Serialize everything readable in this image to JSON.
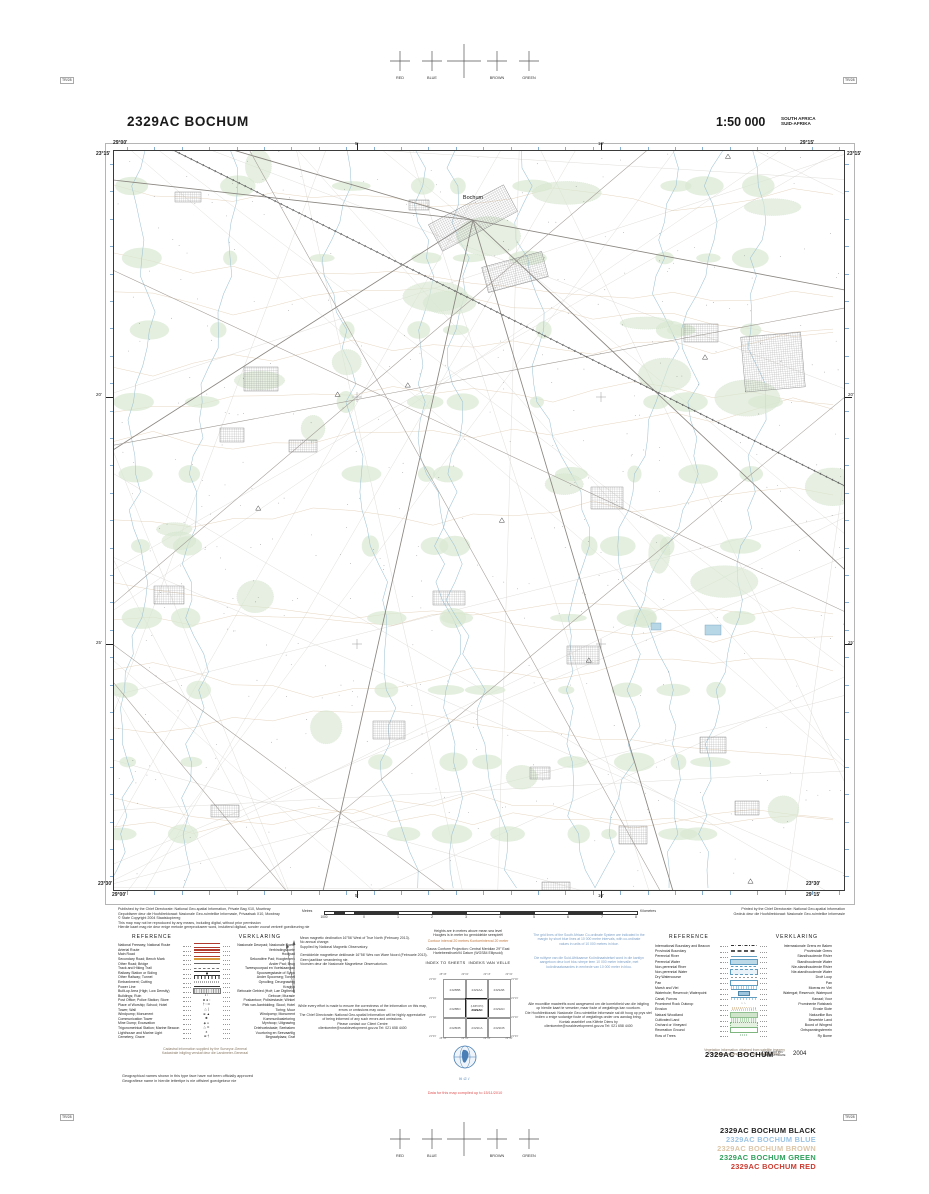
{
  "page": {
    "corner_mark": "TR/28"
  },
  "registration": {
    "labels": [
      "RED",
      "BLUE",
      "BROWN",
      "GREEN"
    ]
  },
  "header": {
    "sheet_title": "2329AC BOCHUM",
    "scale": "1:50 000",
    "country_line1": "SOUTH AFRICA",
    "country_line2": "SUID-AFRIKA"
  },
  "map": {
    "town_label": "Bochum",
    "corners": {
      "top_left_lon": "29°00'",
      "top_left_lat": "23°15'",
      "top_right_lon": "29°15'",
      "top_right_lat": "23°15'",
      "bottom_left_lat": "23°30'",
      "bottom_left_lon": "29°00'",
      "bottom_right_lat": "23°30'",
      "bottom_right_lon": "29°15'"
    },
    "edge_ticks": {
      "top": [
        "5'",
        "10'"
      ],
      "bottom": [
        "5'",
        "10'"
      ],
      "left": [
        "20'",
        "25'"
      ],
      "right": [
        "20'",
        "25'"
      ]
    }
  },
  "imprint": {
    "published": [
      "Published by the Chief Directorate: National Geo-spatial Information, Private Bag X10, Mowbray",
      "Gepubliseer deur die Hoofdirektoraat: Nasionale Geo-ruimtelike Informasie, Privaatsak X10, Mowbray",
      "© State Copyright  2004  Staatskopiereg",
      "This map may not be reproduced by any means, including digital, without prior permission",
      "Hierdie kaart mag nie deur enige metode gereproduseer word, insluitend digitaal, sonder vooraf verkreë goedkeuring nie"
    ],
    "printed": [
      "Printed by the Chief Directorate: National Geo-spatial Information",
      "Gedruk deur die Hoofdirektoraat: Nasionale Geo-ruimtelike Informasie"
    ]
  },
  "scalebar": {
    "metres_label": "Metres",
    "km_label": "Kilometres",
    "metre_ticks": [
      "1000",
      "0"
    ],
    "km_ticks": [
      "1",
      "2",
      "3",
      "4",
      "5",
      "6",
      "7",
      "8"
    ]
  },
  "legend_left": {
    "title_en": "REFERENCE",
    "title_af": "VERKLARING",
    "rows": [
      {
        "en": "National Freeway; National Route",
        "af": "Nasionale Deurpad; Nasionale Roete",
        "sym": "freeway"
      },
      {
        "en": "Arterial Route",
        "af": "Verbindingsroete",
        "sym": "arterial"
      },
      {
        "en": "Main Road",
        "af": "Hoofpad",
        "sym": "main-road"
      },
      {
        "en": "Secondary Road; Bench Mark",
        "af": "Sekondêre Pad; Hoogtemerk",
        "sym": "secondary-road"
      },
      {
        "en": "Other Road; Bridge",
        "af": "Ander Pad; Brug",
        "sym": "other-road"
      },
      {
        "en": "Track and Hiking Trail",
        "af": "Tweespoorpad en Voetslaanpad",
        "sym": "track"
      },
      {
        "en": "Railway Station or Siding",
        "af": "Spoorwegstasie of Sylyn",
        "sym": "rail-station"
      },
      {
        "en": "Other Railway; Tunnel",
        "af": "Ander Spoorweg; Tonnel",
        "sym": "rail"
      },
      {
        "en": "Embankment; Cutting",
        "af": "Opvulling; Deurgrawing",
        "sym": "embankment"
      },
      {
        "en": "Power Line",
        "af": "Kraglyn",
        "sym": "power"
      },
      {
        "en": "Built-up Area (High; Low Density)",
        "af": "Beboude Gebied (Hoë; Lae Digtheid)",
        "sym": "builtup"
      },
      {
        "en": "Buildings; Ruin",
        "af": "Geboue; Murasie",
        "sym": "buildings"
      },
      {
        "en": "Post Office; Police Station; Store",
        "af": "Poskantoor; Polisiestasie; Winkel",
        "sym": "po"
      },
      {
        "en": "Place of Worship; School; Hotel",
        "af": "Plek van Aanbidding; Skool; Hotel",
        "sym": "worship"
      },
      {
        "en": "Tower; Wall",
        "af": "Toring; Muur",
        "sym": "tower"
      },
      {
        "en": "Windpump; Monument",
        "af": "Windpomp; Monument",
        "sym": "monument"
      },
      {
        "en": "Communication Tower",
        "af": "Kommunikasietoring",
        "sym": "comm-tower"
      },
      {
        "en": "Mine Dump; Excavation",
        "af": "Mynhoop; Uitgrawing",
        "sym": "mine"
      },
      {
        "en": "Trigonometrical Station; Marine Beacon",
        "af": "Driehoekstasie; Seebaken",
        "sym": "trig"
      },
      {
        "en": "Lighthouse and Marine Light",
        "af": "Vuurtoring en Seevaartlig",
        "sym": "lighthouse"
      },
      {
        "en": "Cemetery; Grave",
        "af": "Begraafplaas; Graf",
        "sym": "cemetery"
      }
    ]
  },
  "legend_right": {
    "title_en": "REFERENCE",
    "title_af": "VERKLARING",
    "rows": [
      {
        "en": "International Boundary and Beacon",
        "af": "Internasionale Grens en Baken",
        "sym": "intl-boundary"
      },
      {
        "en": "Provincial Boundary",
        "af": "Provinsiale Grens",
        "sym": "prov-boundary"
      },
      {
        "en": "Perennial River",
        "af": "Standhoudende Rivier",
        "sym": "river"
      },
      {
        "en": "Perennial Water",
        "af": "Standhoudende Water",
        "sym": "water"
      },
      {
        "en": "Non-perennial River",
        "af": "Nie-standhoudende Rivier",
        "sym": "np-river"
      },
      {
        "en": "Non-perennial Water",
        "af": "Nie-standhoudende Water",
        "sym": "np-water"
      },
      {
        "en": "Dry Watercourse",
        "af": "Droë Loop",
        "sym": "dry"
      },
      {
        "en": "Pan",
        "af": "Pan",
        "sym": "pan"
      },
      {
        "en": "Marsh and Vlei",
        "af": "Moeras en Vlei",
        "sym": "marsh"
      },
      {
        "en": "Waterhole; Reservoir; Waterpoint",
        "af": "Watergat; Reservoir; Waterpunt",
        "sym": "reservoir"
      },
      {
        "en": "Canal; Furrow",
        "af": "Kanaal; Voor",
        "sym": "canal"
      },
      {
        "en": "Prominent Rock Outcrop",
        "af": "Prominente Rotsbank",
        "sym": "rock"
      },
      {
        "en": "Erosion",
        "af": "Erosie Slote",
        "sym": "erosion"
      },
      {
        "en": "Natural Woodland",
        "af": "Natuurlike Bos",
        "sym": "woodland"
      },
      {
        "en": "Cultivated Land",
        "af": "Bewerkte Land",
        "sym": "cultivated"
      },
      {
        "en": "Orchard or Vineyard",
        "af": "Boord of Wingerd",
        "sym": "orchard"
      },
      {
        "en": "Recreation Ground",
        "af": "Ontspanningsterrein",
        "sym": "recreation"
      },
      {
        "en": "Row of Trees",
        "af": "Ry Bome",
        "sym": "trees"
      }
    ]
  },
  "notes": {
    "heights": [
      "Heights are in metres above mean sea level",
      "Hoogtes is in meter bo gemiddelde seespieël"
    ],
    "contour": "Contour interval 20 metres      Kontoerinterval 20 meter",
    "projection": [
      "Gauss Conform Projection: Central Meridian 29° East",
      "Hartebeesthoek94 Datum (WGS84 Ellipsoid)"
    ],
    "grid_en": [
      "The grid lines of the South African Co-ordinate System are indicated in the",
      "margin by short blue lines at 10 000 metre intervals, with co-ordinate",
      "values in units of 10 000 metres in blue."
    ],
    "grid_af": [
      "Die ruitlyne van die Suid-Afrikaanse Koördinaatstelsel word in die kantlyn",
      "aangetoon deur kort blou strepe teen 10 000 meter intervalle, met",
      "koördinaatwaardes in eenhede van 10 000 meter in blou."
    ],
    "errors_en": [
      "While every effort is made to ensure the correctness of the information on this map,",
      "errors or omissions may occur.",
      "The Chief Directorate: National Geo-spatial Information will be highly appreciative",
      "of being informed of any such errors and omissions.",
      "Please contact our Client Centre",
      "clientcentre@ruraldevelopment.gov.za          Tel: 021 658 4400"
    ],
    "errors_af": [
      "Alle moontlike maatreëls word aangewend om die korrektheid van die inligting",
      "op hierdie kaart te verseker, maar foute of weglatings kan voorkom.",
      "Die Hoofdirektoraat: Nasionale Geo-ruimtelike Informasie sal dit hoog op prys stel",
      "indien u enige sodanige foute of weglatings onder ons aandag bring.",
      "Kontak asseblief ons Kliënte Diens by",
      "clientcentre@ruraldevelopment.gov.za          Tel: 021 658 4400"
    ],
    "cadastral": [
      "Cadastral information supplied by the Surveyor-General",
      "Kadastrale inligting verskaf deur die Landmeter-Generaal"
    ],
    "names": [
      "Geographical names shown in this type face have not been officially approved",
      "Geografiese name in hierdie lettertipe is nie offisieel goedgekeur nie"
    ],
    "vegetation": [
      "Vegetation information obtained from satellite imagery",
      "Plantegroei-inligting verkry vanaf satellietbeelde"
    ]
  },
  "declination": {
    "en": [
      "Mean magnetic declination 16°56' West of True North (February 2013).",
      "No annual change.",
      "Supplied by National Magnetic Observatory."
    ],
    "af": [
      "Gemiddelde magnetiese deklinasie 16°56' Wes van Ware Noord (Februarie 2013).",
      "Geen jaarlikse verandering nie.",
      "Voorsien deur die Nasionale Magnetiese Observatorium."
    ]
  },
  "index": {
    "title_en": "INDEX TO SHEETS",
    "title_af": "INDEKS VAN VELLE",
    "top_labels": [
      "28°45'",
      "29°00'",
      "29°15'",
      "29°30'"
    ],
    "side_labels": [
      "23°00'",
      "23°15'",
      "23°30'",
      "23°45'"
    ],
    "cells": [
      [
        "2328BB",
        "2329AA",
        "2329AB"
      ],
      [
        "2328BD",
        "2329AC",
        "2329AD"
      ],
      [
        "2328DB",
        "2329CA",
        "2329CB"
      ]
    ],
    "center_note": "(LIMPOPO)"
  },
  "footer": {
    "sheet_id": "2329AC BOCHUM",
    "edition_line1": "THIRD EDITION",
    "edition_line2": "DERDE UITGAWE",
    "year": "2004",
    "compiled_note": "Data for this map compiled up to 15/11/2010",
    "logo_caption": "NGI"
  },
  "plates": [
    {
      "label": "2329AC BOCHUM BLACK",
      "color": "#222222"
    },
    {
      "label": "2329AC BOCHUM BLUE",
      "color": "#9cc4e4"
    },
    {
      "label": "2329AC BOCHUM BROWN",
      "color": "#dcc6a8"
    },
    {
      "label": "2329AC BOCHUM GREEN",
      "color": "#2fa05c"
    },
    {
      "label": "2329AC BOCHUM RED",
      "color": "#cc3b30"
    }
  ],
  "palette": {
    "paper": "#ffffff",
    "frame": "#3a3a3a",
    "farm_line": "#d2d0cc",
    "road": "#a09a94",
    "main_road": "#8a8680",
    "railway": "#5a5a5a",
    "water": "#9fc3d4",
    "dam": "#b7d6e6",
    "green": "#d9e8d2",
    "green_edge": "#a9c9a0",
    "contour_brown": "#d8bd9a",
    "settlement": "#8a8a8a",
    "blue_tick": "#85aed0",
    "red_text": "#e05050",
    "blue_text": "#7b9fc7",
    "logo_blue": "#4a7fb5"
  }
}
